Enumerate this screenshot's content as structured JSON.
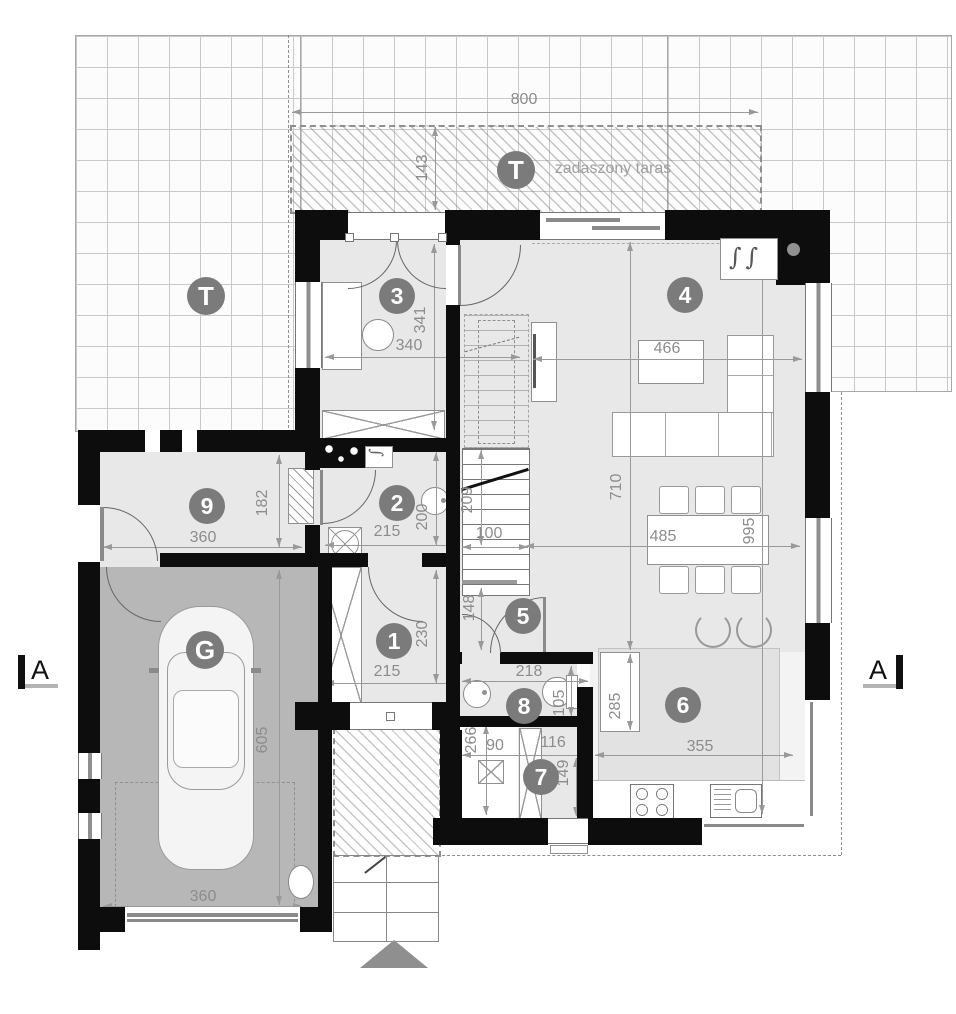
{
  "plan": {
    "rooms": {
      "r1": "1",
      "r2": "2",
      "r3": "3",
      "r4": "4",
      "r5": "5",
      "r6": "6",
      "r7": "7",
      "r8": "8",
      "r9": "9",
      "garage": "G",
      "terrace_top": "T",
      "terrace_left": "T"
    },
    "labels": {
      "covered_terrace": "zadaszony taras",
      "section_left": "A",
      "section_right": "A"
    },
    "symbols": {
      "fireplace": "∫∫",
      "boiler": "∫"
    },
    "dims": {
      "d800": "800",
      "d143": "143",
      "d340": "340",
      "d341": "341",
      "d466": "466",
      "d710": "710",
      "d485": "485",
      "d995": "995",
      "d215_room2": "215",
      "d200": "200",
      "d215_room1": "215",
      "d230": "230",
      "d209": "209",
      "d100": "100",
      "d148": "148",
      "d218": "218",
      "d105": "105",
      "d266": "266",
      "d90": "90",
      "d116": "116",
      "d149": "149",
      "d285": "285",
      "d355": "355",
      "d360_hall": "360",
      "d182": "182",
      "d605": "605",
      "d360_garage": "360"
    }
  }
}
